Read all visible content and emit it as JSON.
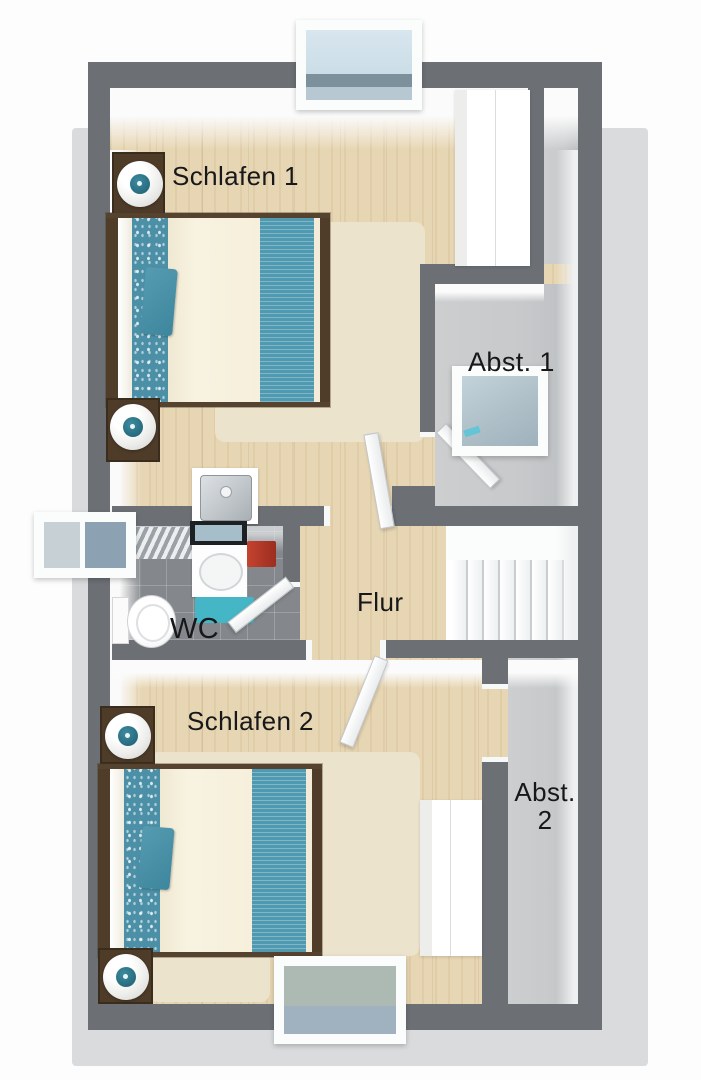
{
  "plan": {
    "rooms": {
      "schlafen1": {
        "label": "Schlafen 1"
      },
      "abst1": {
        "label": "Abst. 1"
      },
      "wc": {
        "label": "WC"
      },
      "flur": {
        "label": "Flur"
      },
      "schlafen2": {
        "label": "Schlafen 2"
      },
      "abst2": {
        "line1": "Abst.",
        "line2": "2"
      }
    },
    "colors": {
      "wall": "#6c7075",
      "wood_floor": "#e7d6b3",
      "storage_floor": "#c8cacc",
      "wc_tile": "#84888c",
      "accent_teal": "#4f9ab0",
      "towel_red": "#b5382a",
      "mat_teal": "#45b6c6",
      "shadow": "#d9dbdd"
    },
    "furniture": {
      "beds": 2,
      "nightstands": 4,
      "lamps": 4,
      "wardrobes": 2,
      "items": [
        "double-bed",
        "nightstand",
        "sphere-lamp",
        "rug",
        "wardrobe",
        "toilet",
        "washbasin",
        "vanity-mirror",
        "towel",
        "bath-mat",
        "radiator",
        "staircase",
        "door"
      ]
    },
    "windows": [
      "top-skylight",
      "wc-side-window",
      "abst1-skylight",
      "bottom-skylight"
    ],
    "stairs": {
      "steps": 8
    }
  }
}
